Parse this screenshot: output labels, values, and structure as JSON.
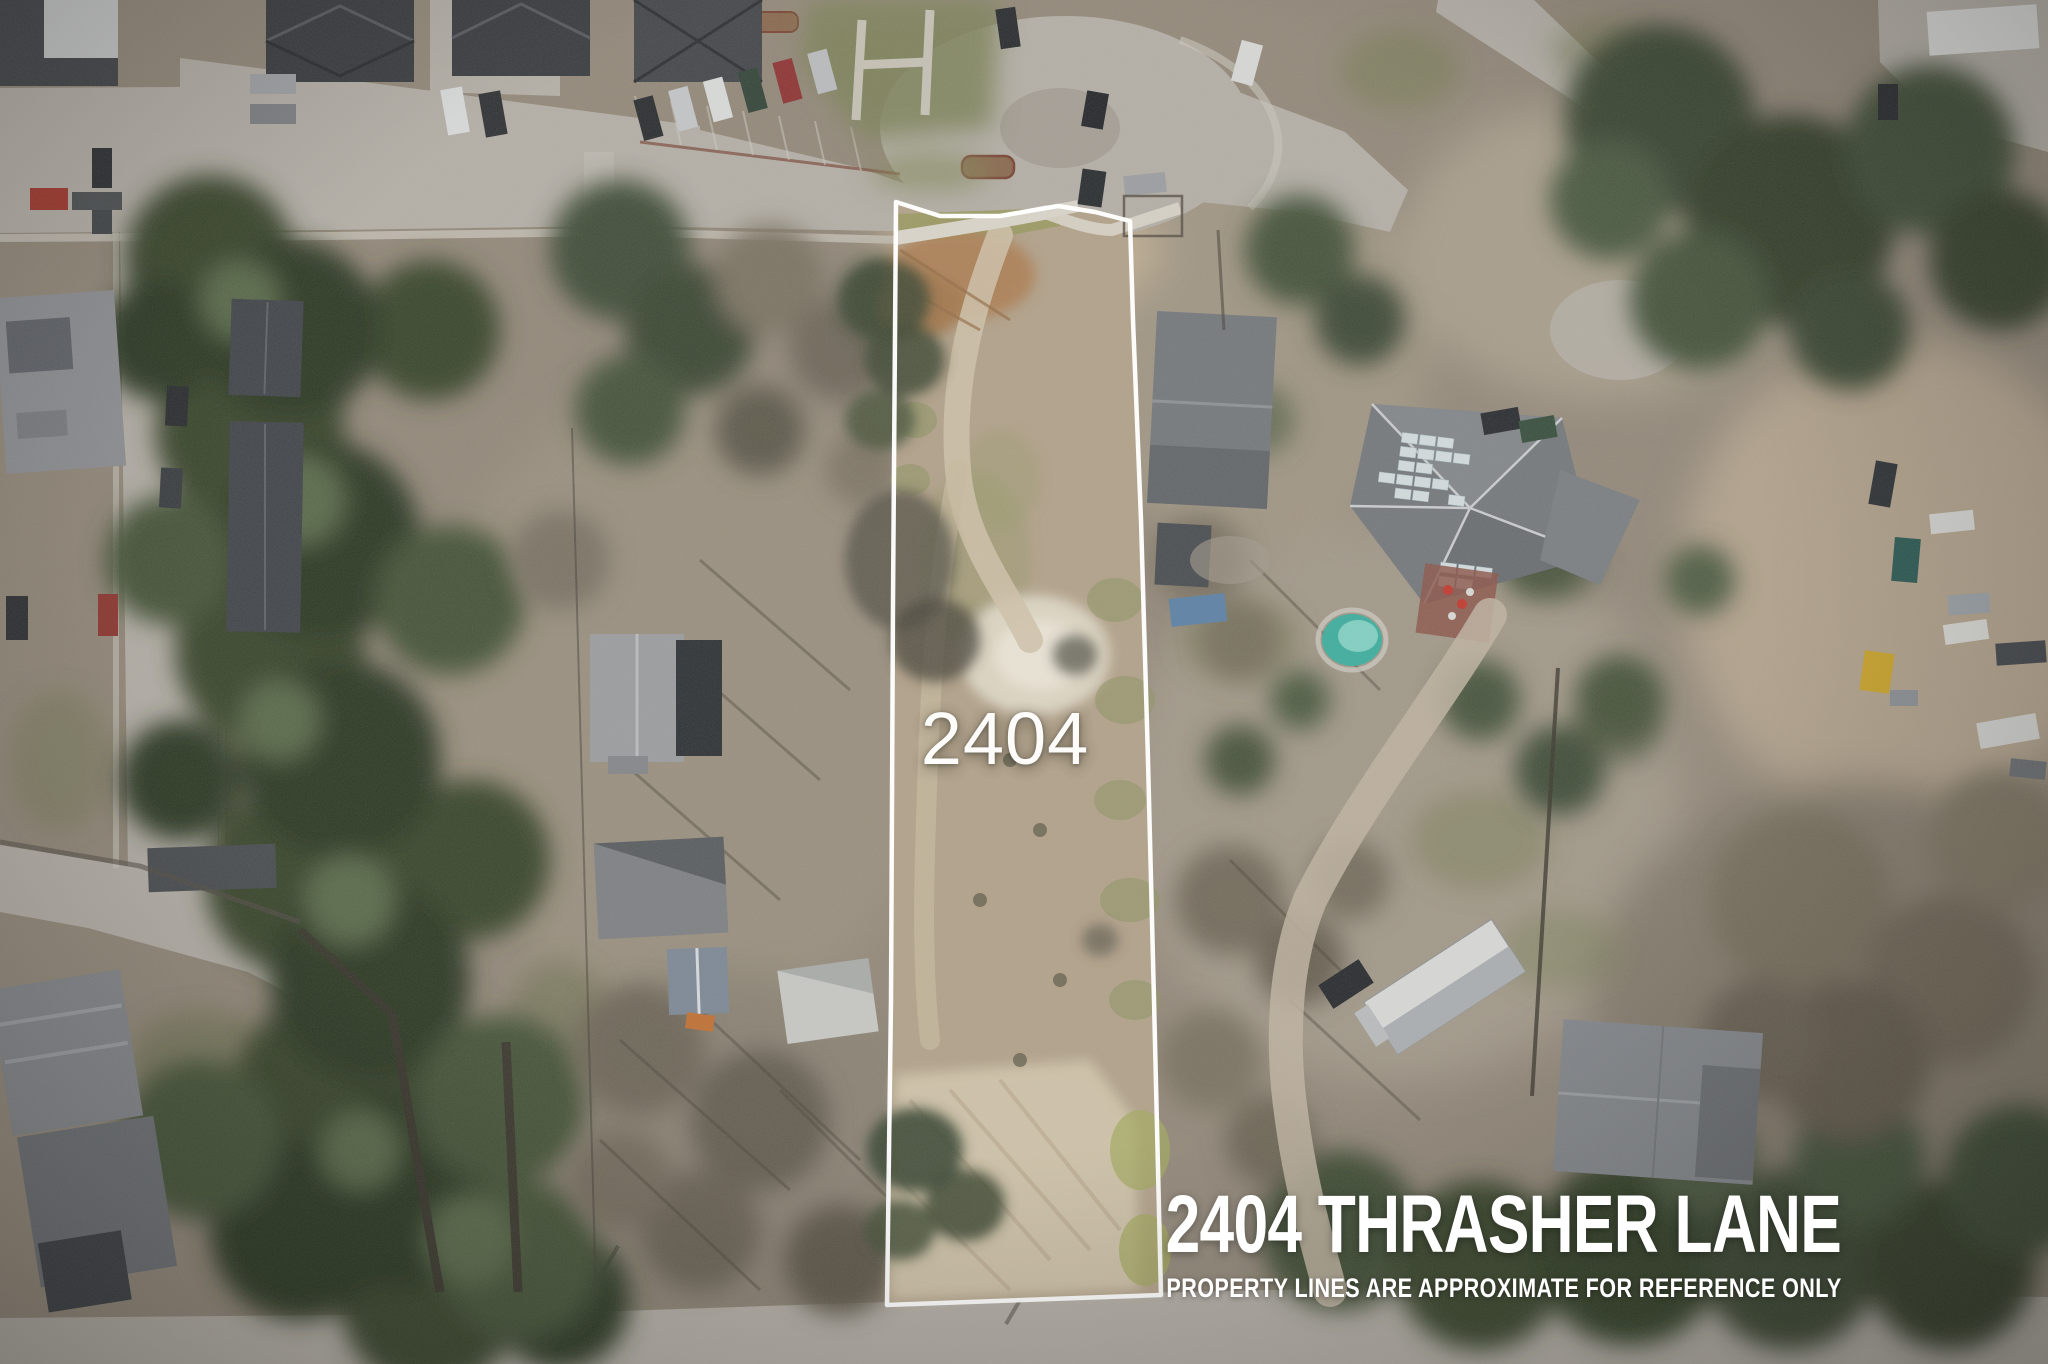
{
  "overlay": {
    "parcel_number": "2404",
    "address": "2404 THRASHER LANE",
    "disclaimer": "PROPERTY LINES ARE APPROXIMATE FOR REFERENCE ONLY"
  },
  "colors": {
    "boundary": "#ffffff",
    "label_text": "#ffffff"
  }
}
